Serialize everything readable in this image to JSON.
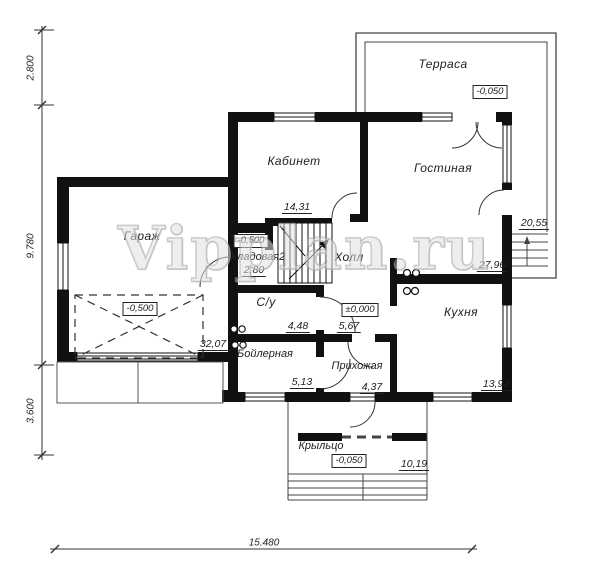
{
  "drawing": {
    "watermark": "Vipplan.ru",
    "rooms": {
      "terrace": {
        "name": "Терраса",
        "area": "20,55",
        "level": "-0,050"
      },
      "study": {
        "name": "Кабинет",
        "area": "14,31"
      },
      "living": {
        "name": "Гостиная",
        "area": "27,96"
      },
      "garage": {
        "name": "Гараж",
        "area": "32,07",
        "level": "-0,500"
      },
      "storage": {
        "name": "Кладовая2",
        "area": "2,80",
        "level": "-0,500"
      },
      "hall": {
        "name": "Холл",
        "area": "5,67",
        "level": "±0,000"
      },
      "bathroom": {
        "name": "С/у",
        "area": "4,48"
      },
      "boiler": {
        "name": "Бойлерная",
        "area": "5,13"
      },
      "entry": {
        "name": "Прихожая",
        "area": "4,37"
      },
      "kitchen": {
        "name": "Кухня",
        "area": "13,92"
      },
      "porch": {
        "name": "Крыльцо",
        "area": "10,19",
        "level": "-0,050"
      }
    },
    "dimensions": {
      "left_top": "2.800",
      "left_middle": "9.780",
      "left_bottom": "3.600",
      "bottom": "15.480"
    }
  }
}
